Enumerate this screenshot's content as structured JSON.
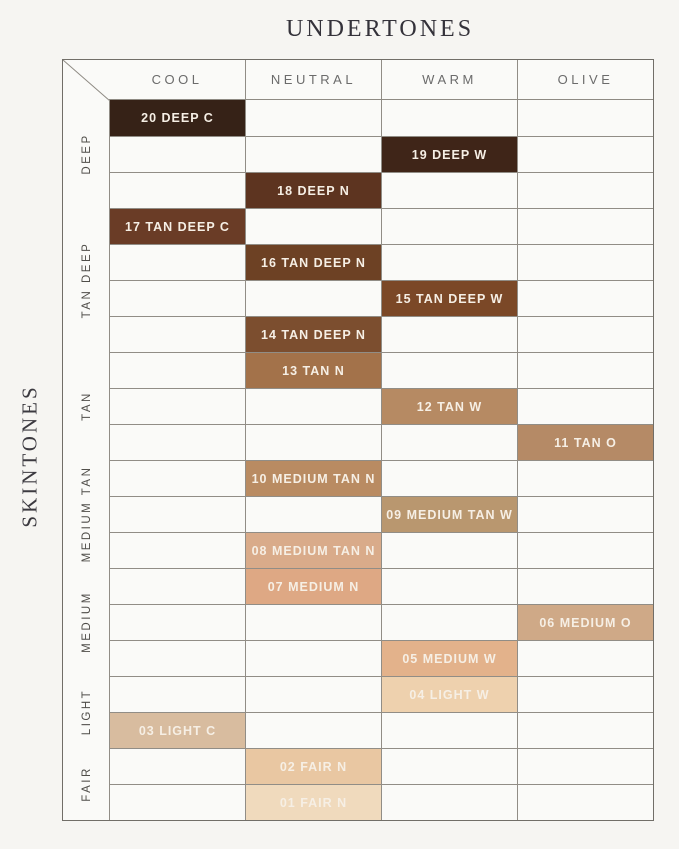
{
  "chart_data": {
    "type": "heatmap",
    "title": "UNDERTONES",
    "ylabel": "SKINTONES",
    "columns": [
      "COOL",
      "NEUTRAL",
      "WARM",
      "OLIVE"
    ],
    "row_groups": [
      {
        "label": "DEEP",
        "rows": 3
      },
      {
        "label": "TAN DEEP",
        "rows": 4
      },
      {
        "label": "TAN",
        "rows": 3
      },
      {
        "label": "MEDIUM TAN",
        "rows": 3
      },
      {
        "label": "MEDIUM",
        "rows": 3
      },
      {
        "label": "LIGHT",
        "rows": 2
      },
      {
        "label": "FAIR",
        "rows": 2
      }
    ],
    "cells": [
      {
        "label": "20 DEEP C",
        "undertone": "COOL",
        "color": "#362217"
      },
      {
        "label": "19 DEEP W",
        "undertone": "WARM",
        "color": "#3f2518"
      },
      {
        "label": "18 DEEP N",
        "undertone": "NEUTRAL",
        "color": "#5d3420"
      },
      {
        "label": "17 TAN DEEP C",
        "undertone": "COOL",
        "color": "#6a3c26"
      },
      {
        "label": "16 TAN DEEP N",
        "undertone": "NEUTRAL",
        "color": "#6d4124"
      },
      {
        "label": "15 TAN DEEP W",
        "undertone": "WARM",
        "color": "#7b4827"
      },
      {
        "label": "14 TAN DEEP N",
        "undertone": "NEUTRAL",
        "color": "#7c4e2f"
      },
      {
        "label": "13 TAN N",
        "undertone": "NEUTRAL",
        "color": "#a3724a"
      },
      {
        "label": "12 TAN W",
        "undertone": "WARM",
        "color": "#b68a63"
      },
      {
        "label": "11 TAN O",
        "undertone": "OLIVE",
        "color": "#b58a66"
      },
      {
        "label": "10 MEDIUM TAN N",
        "undertone": "NEUTRAL",
        "color": "#b98b62"
      },
      {
        "label": "09 MEDIUM TAN W",
        "undertone": "WARM",
        "color": "#b9976f"
      },
      {
        "label": "08 MEDIUM TAN N",
        "undertone": "NEUTRAL",
        "color": "#d9ab8a"
      },
      {
        "label": "07 MEDIUM N",
        "undertone": "NEUTRAL",
        "color": "#dea884"
      },
      {
        "label": "06 MEDIUM O",
        "undertone": "OLIVE",
        "color": "#cfa987"
      },
      {
        "label": "05 MEDIUM W",
        "undertone": "WARM",
        "color": "#e3b28b"
      },
      {
        "label": "04 LIGHT W",
        "undertone": "WARM",
        "color": "#eed1ae"
      },
      {
        "label": "03 LIGHT C",
        "undertone": "COOL",
        "color": "#d8bc9f"
      },
      {
        "label": "02 FAIR N",
        "undertone": "NEUTRAL",
        "color": "#e9c7a2"
      },
      {
        "label": "01 FAIR N",
        "undertone": "NEUTRAL",
        "color": "#f0dabd"
      }
    ],
    "colors": {
      "page_background": "#f6f5f2",
      "cell_background": "#fafaf8",
      "grid_line": "#918d86",
      "outer_border": "#716e68",
      "swatch_text": "#f6efe5",
      "header_text": "#6b6b6b",
      "title_text": "#34323a"
    }
  }
}
